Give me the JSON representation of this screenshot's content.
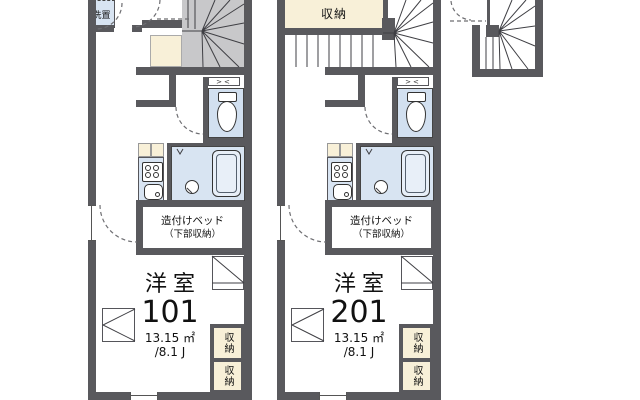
{
  "plan": {
    "unit101": {
      "room_type": "洋室",
      "unit_number": "101",
      "area_m2": "13.15 ㎡",
      "area_tatami": "/8.1 J",
      "bed_line1": "造付けベッド",
      "bed_line2": "（下部収納）",
      "washer_label": "洗置",
      "storage_label_1": "収納",
      "storage_label_2": "収納"
    },
    "unit201": {
      "room_type": "洋室",
      "unit_number": "201",
      "area_m2": "13.15 ㎡",
      "area_tatami": "/8.1 J",
      "bed_line1": "造付けベッド",
      "bed_line2": "（下部収納）",
      "washer_label": "洗置",
      "storage_label_1": "収納",
      "storage_label_2": "収納",
      "top_storage_label": "収納"
    },
    "icons": {
      "louver_glyph": "><"
    },
    "colors": {
      "wall": "#59595d",
      "stair_fill": "#c8c8ca",
      "storage_cream": "#f8f0d8",
      "water_blue": "#d8e4f2",
      "toilet_blue": "#d2e0f0",
      "fixture_light": "#e8eff8"
    }
  }
}
